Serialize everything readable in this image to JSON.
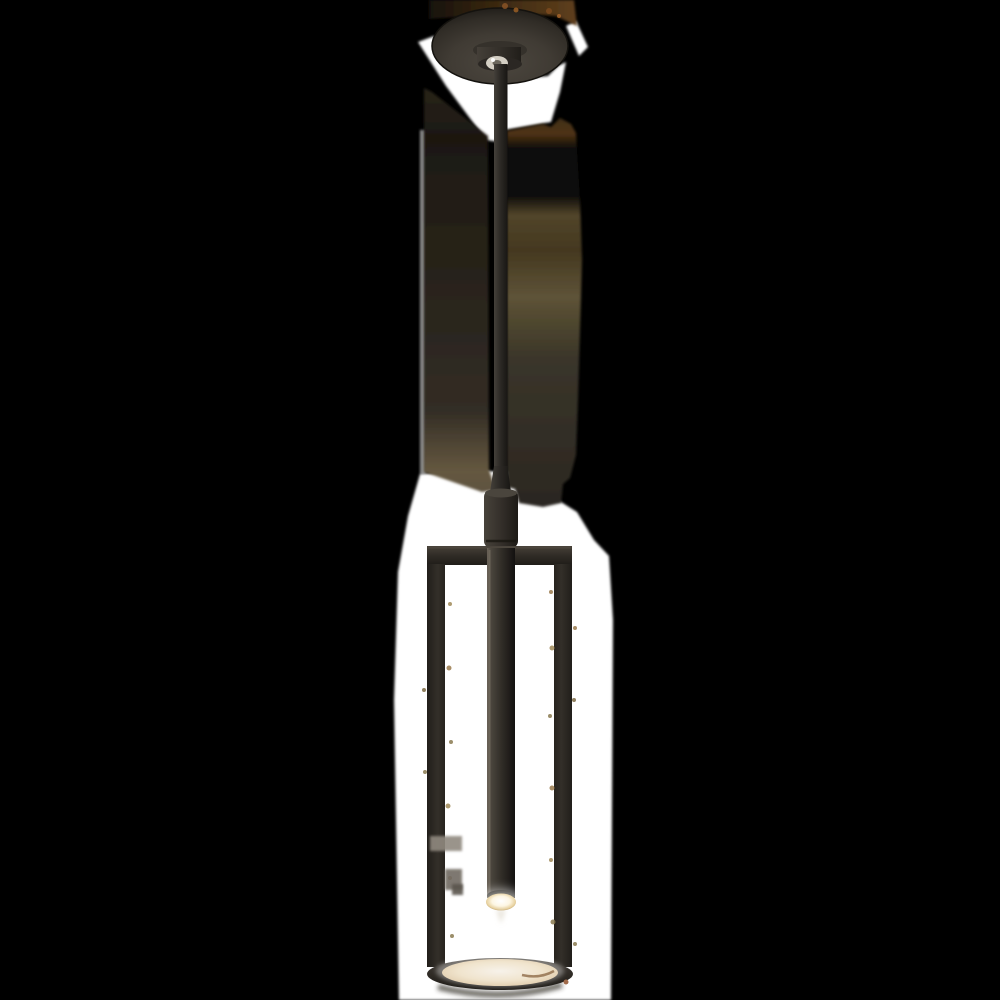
{
  "image": {
    "type": "product-photo",
    "subject": "tall slim bronze pendant light with open cylindrical cage, LED candle stem and glowing glass diffuser",
    "background_style": "rough white cutout on black with brown compression artifacts"
  },
  "canvas": {
    "width": 1000,
    "height": 1000
  },
  "colors": {
    "background": "#000000",
    "cutout": "#ffffff",
    "disc_1": "#4c473f",
    "disc_2": "#403b34",
    "disc_3": "#302c26",
    "disc_4": "#1e1b17",
    "disc_outline": "#14120e",
    "flange": "#35312b",
    "hub_1": "#443f38",
    "hub_2": "#34302a",
    "hub_3": "#211e1a",
    "hub_base": "#2b2723",
    "nipple": "#d3cec3",
    "nipple_core": "#6b665c",
    "glint": "#ffffff",
    "rod_1": "#44403a",
    "rod_2": "#2d2a26",
    "rod_3": "#181613",
    "coupler_1": "#48433b",
    "coupler_2": "#342f2a",
    "coupler_3": "#1d1a16",
    "coupler_cap": "#4a453d",
    "seam": "#17150f",
    "bar_1": "#474138",
    "bar_2": "#302c26",
    "bar_3": "#201d19",
    "bar_hl": "#4e4840",
    "rail_1": "#211e1a",
    "rail_2": "#332f29",
    "rail_3": "#27231e",
    "stem_1": "#6a6257",
    "stem_2": "#4b463e",
    "stem_3": "#322e28",
    "stem_4": "#131110",
    "stem_hl": "#7a7265",
    "stem_cap": "#17150f",
    "lens_1": "#ffffff",
    "lens_2": "#fdf6e3",
    "lens_3": "#e8d2a0",
    "lens_4": "#b0905c",
    "wisp": "#d8d0c0",
    "ring_1": "#403b34",
    "ring_2": "#2c2823",
    "ring_3": "#1d1a16",
    "ring_shadow": "#2e2a24",
    "diff_1": "#f7f2ea",
    "diff_2": "#f0e4cd",
    "diff_3": "#e3d0b2",
    "diff_4": "#cdb698",
    "streak": "#8f6b49",
    "halo": "#ffffff",
    "copper": "#a06a4a",
    "mL1": "#28231a",
    "mL2": "#1c1811",
    "mL3": "#262117",
    "mL4": "#2c2720",
    "mL5": "#332d25",
    "mL6": "#4f4534",
    "mL7": "#655840",
    "mL8": "#5e5240",
    "mR1": "#3f2e16",
    "mR2": "#4f3314",
    "mR3": "#0d0c09",
    "mR4": "#0e0d0a",
    "mR5": "#52452a",
    "mR6": "#44381f",
    "mR7": "#5e5338",
    "mR8": "#50482f",
    "mR9": "#3a352a",
    "mR10": "#2b2721",
    "strip_1": "#17110a",
    "strip_2": "#3a2811",
    "strip_3": "#5f3f1c"
  },
  "parts": {
    "canopy": "ceiling canopy plate",
    "rod": "drop rod",
    "coupler": "stem coupler",
    "cage": "open rectangular cage frame",
    "stem": "LED candle stem",
    "lens": "LED lens",
    "ring": "bottom ring",
    "diffuser": "glass diffuser disc"
  },
  "artifacts": {
    "speckles": [
      {
        "x": 505,
        "y": 6,
        "r": 3,
        "c": "#8a5426"
      },
      {
        "x": 516,
        "y": 10,
        "r": 2.5,
        "c": "#9a5e24"
      },
      {
        "x": 549,
        "y": 11,
        "r": 3,
        "c": "#7d4a1e"
      },
      {
        "x": 559,
        "y": 16,
        "r": 2,
        "c": "#a4642a"
      },
      {
        "x": 450,
        "y": 604,
        "r": 2,
        "c": "#a08a58"
      },
      {
        "x": 449,
        "y": 668,
        "r": 2.5,
        "c": "#9a7a4c"
      },
      {
        "x": 451,
        "y": 742,
        "r": 2,
        "c": "#8a7a50"
      },
      {
        "x": 448,
        "y": 806,
        "r": 2.5,
        "c": "#a08a58"
      },
      {
        "x": 450,
        "y": 878,
        "r": 2,
        "c": "#9a7a4c"
      },
      {
        "x": 452,
        "y": 936,
        "r": 2,
        "c": "#8a7a50"
      },
      {
        "x": 551,
        "y": 592,
        "r": 2,
        "c": "#9a7a4c"
      },
      {
        "x": 552,
        "y": 648,
        "r": 2.5,
        "c": "#a08a58"
      },
      {
        "x": 550,
        "y": 716,
        "r": 2,
        "c": "#8a7a50"
      },
      {
        "x": 552,
        "y": 788,
        "r": 2.5,
        "c": "#9a7a4c"
      },
      {
        "x": 551,
        "y": 860,
        "r": 2,
        "c": "#a08a58"
      },
      {
        "x": 553,
        "y": 922,
        "r": 2.5,
        "c": "#8a7a50"
      },
      {
        "x": 424,
        "y": 690,
        "r": 2,
        "c": "#7d6a44"
      },
      {
        "x": 425,
        "y": 772,
        "r": 2,
        "c": "#8a7a50"
      },
      {
        "x": 575,
        "y": 628,
        "r": 2,
        "c": "#9a7a4c"
      },
      {
        "x": 574,
        "y": 700,
        "r": 2,
        "c": "#7d6a44"
      },
      {
        "x": 575,
        "y": 944,
        "r": 2,
        "c": "#8a7a50"
      }
    ],
    "blocks": [
      {
        "x": 430,
        "y": 836,
        "w": 32,
        "h": 15,
        "c": "#90897f"
      },
      {
        "x": 445,
        "y": 869,
        "w": 17,
        "h": 21,
        "c": "#716b62"
      },
      {
        "x": 452,
        "y": 884,
        "w": 11,
        "h": 11,
        "c": "#5a554d"
      }
    ]
  }
}
